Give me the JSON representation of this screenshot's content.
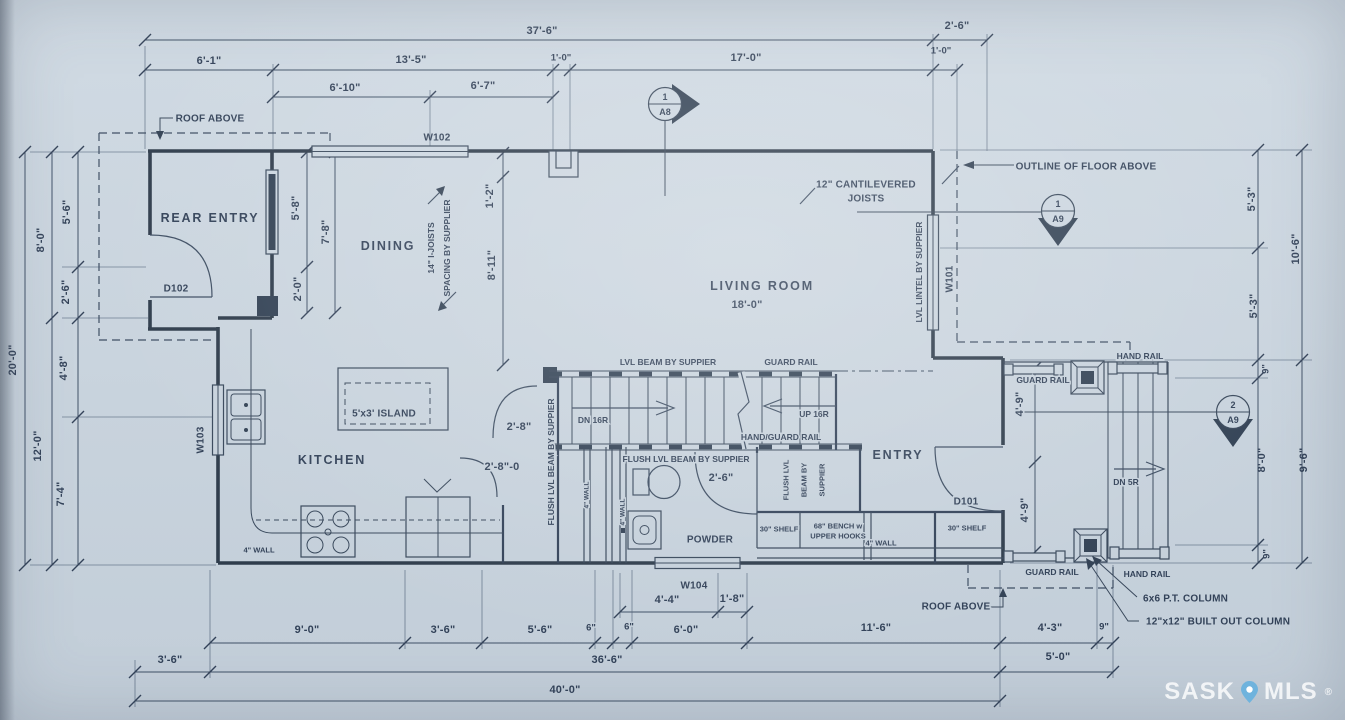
{
  "colors": {
    "paper": "#cbd6e0",
    "ink": "#22324a",
    "watermark_text": "rgba(255,255,255,0.8)",
    "pin": "#6fb3dd"
  },
  "watermark": {
    "sask": "SASK",
    "mls": "MLS",
    "reg": "®"
  },
  "rooms": {
    "rear_entry": "REAR ENTRY",
    "dining": "DINING",
    "kitchen": "KITCHEN",
    "living_room": "LIVING ROOM",
    "powder": "POWDER",
    "entry": "ENTRY",
    "island": "5'x3' ISLAND"
  },
  "openings": {
    "d101": "D101",
    "d102": "D102",
    "w101": "W101",
    "w102": "W102",
    "w103": "W103",
    "w104": "W104"
  },
  "markers": {
    "a8_1": {
      "num": "1",
      "sheet": "A8"
    },
    "a9_1": {
      "num": "1",
      "sheet": "A9"
    },
    "a9_2": {
      "num": "2",
      "sheet": "A9"
    }
  },
  "notes": {
    "roof_above": "ROOF ABOVE",
    "outline_floor_above": "OUTLINE OF FLOOR ABOVE",
    "cantilever_1": "12\" CANTILEVERED",
    "cantilever_2": "JOISTS",
    "ijoists_1": "14\" I-JOISTS",
    "ijoists_2": "SPACING BY SUPPLIER",
    "lvl_lintel": "LVL LINTEL BY SUPPIER",
    "lvl_beam": "LVL BEAM BY SUPPIER",
    "flush_beam": "FLUSH LVL BEAM BY SUPPIER",
    "flush_1": "FLUSH LVL",
    "flush_2": "BEAM BY",
    "flush_3": "SUPPIER",
    "guard_rail": "GUARD RAIL",
    "hand_rail": "HAND RAIL",
    "hand_guard_rail": "HAND/GUARD RAIL",
    "dn16": "DN 16R",
    "up16": "UP 16R",
    "dn5": "DN 5R",
    "shelf_30": "30\" SHELF",
    "bench_1": "68\" BENCH w",
    "bench_2": "UPPER HOOKS",
    "wall_4": "4\" WALL",
    "col_6x6": "6x6 P.T. COLUMN",
    "col_12x12": "12\"x12\" BUILT OUT COLUMN"
  },
  "dims": {
    "d37_6": "37'-6\"",
    "d2_6": "2'-6\"",
    "d6_1": "6'-1\"",
    "d13_5": "13'-5\"",
    "d1_0": "1'-0\"",
    "d17_0": "17'-0\"",
    "d6_10": "6'-10\"",
    "d6_7": "6'-7\"",
    "d20_0": "20'-0\"",
    "d8_0": "8'-0\"",
    "d12_0": "12'-0\"",
    "d5_6": "5'-6\"",
    "d4_8": "4'-8\"",
    "d7_4": "7'-4\"",
    "d5_3": "5'-3\"",
    "d10_6": "10'-6\"",
    "d9in": "9\"",
    "d9_6": "9'-6\"",
    "d5_8": "5'-8\"",
    "d7_8": "7'-8\"",
    "d2_0": "2'-0\"",
    "d1_2": "1'-2\"",
    "d8_11": "8'-11\"",
    "d18_0": "18'-0\"",
    "d2_8": "2'-8\"",
    "d2_8_0": "2'-8\"-0",
    "d4_9": "4'-9\"",
    "d9_0": "9'-0\"",
    "d3_6": "3'-6\"",
    "d6in": "6\"",
    "d6_0": "6'-0\"",
    "d4_4": "4'-4\"",
    "d1_8": "1'-8\"",
    "d11_6": "11'-6\"",
    "d4_3": "4'-3\"",
    "d36_6": "36'-6\"",
    "d5_0": "5'-0\"",
    "d40_0": "40'-0\""
  }
}
